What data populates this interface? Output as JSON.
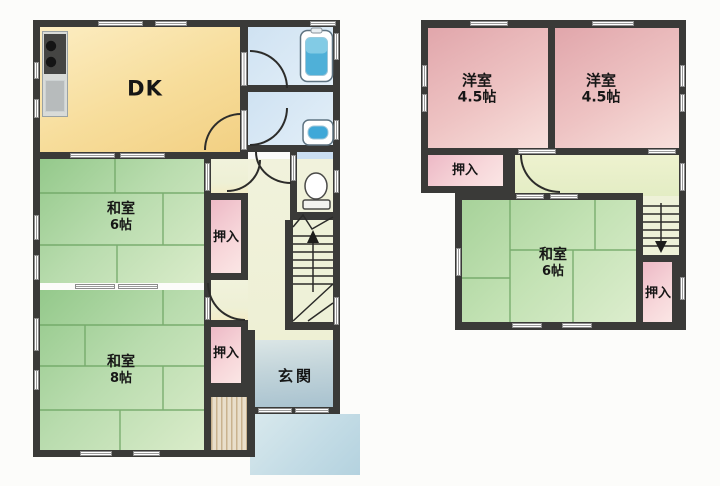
{
  "palette": {
    "wall": "#3a3a38",
    "tatami_green": "#a9d39c",
    "dk_yellow": "#f6dc96",
    "western_pink": "#e9b9bc",
    "closet_pink": "#f3cdd4",
    "water_blue": "#d3e5f4",
    "bathtub_blue": "#45a9d6",
    "genkan_blue_gray": "#b4c9d3",
    "porch_blue": "#c7dde8",
    "hall_cream": "#f1f2dc",
    "stairs_cream": "#eef1d8"
  },
  "floor1": {
    "dk": "DK",
    "washitsu6_name": "和室",
    "washitsu6_size": "6帖",
    "oshiire_upper": "押入",
    "washitsu8_name": "和室",
    "washitsu8_size": "8帖",
    "oshiire_lower": "押入",
    "genkan": "玄関"
  },
  "floor2": {
    "youshitsu_left_name": "洋室",
    "youshitsu_left_size": "4.5帖",
    "youshitsu_right_name": "洋室",
    "youshitsu_right_size": "4.5帖",
    "oshiire_left": "押入",
    "washitsu6_name": "和室",
    "washitsu6_size": "6帖",
    "oshiire_right": "押入"
  }
}
